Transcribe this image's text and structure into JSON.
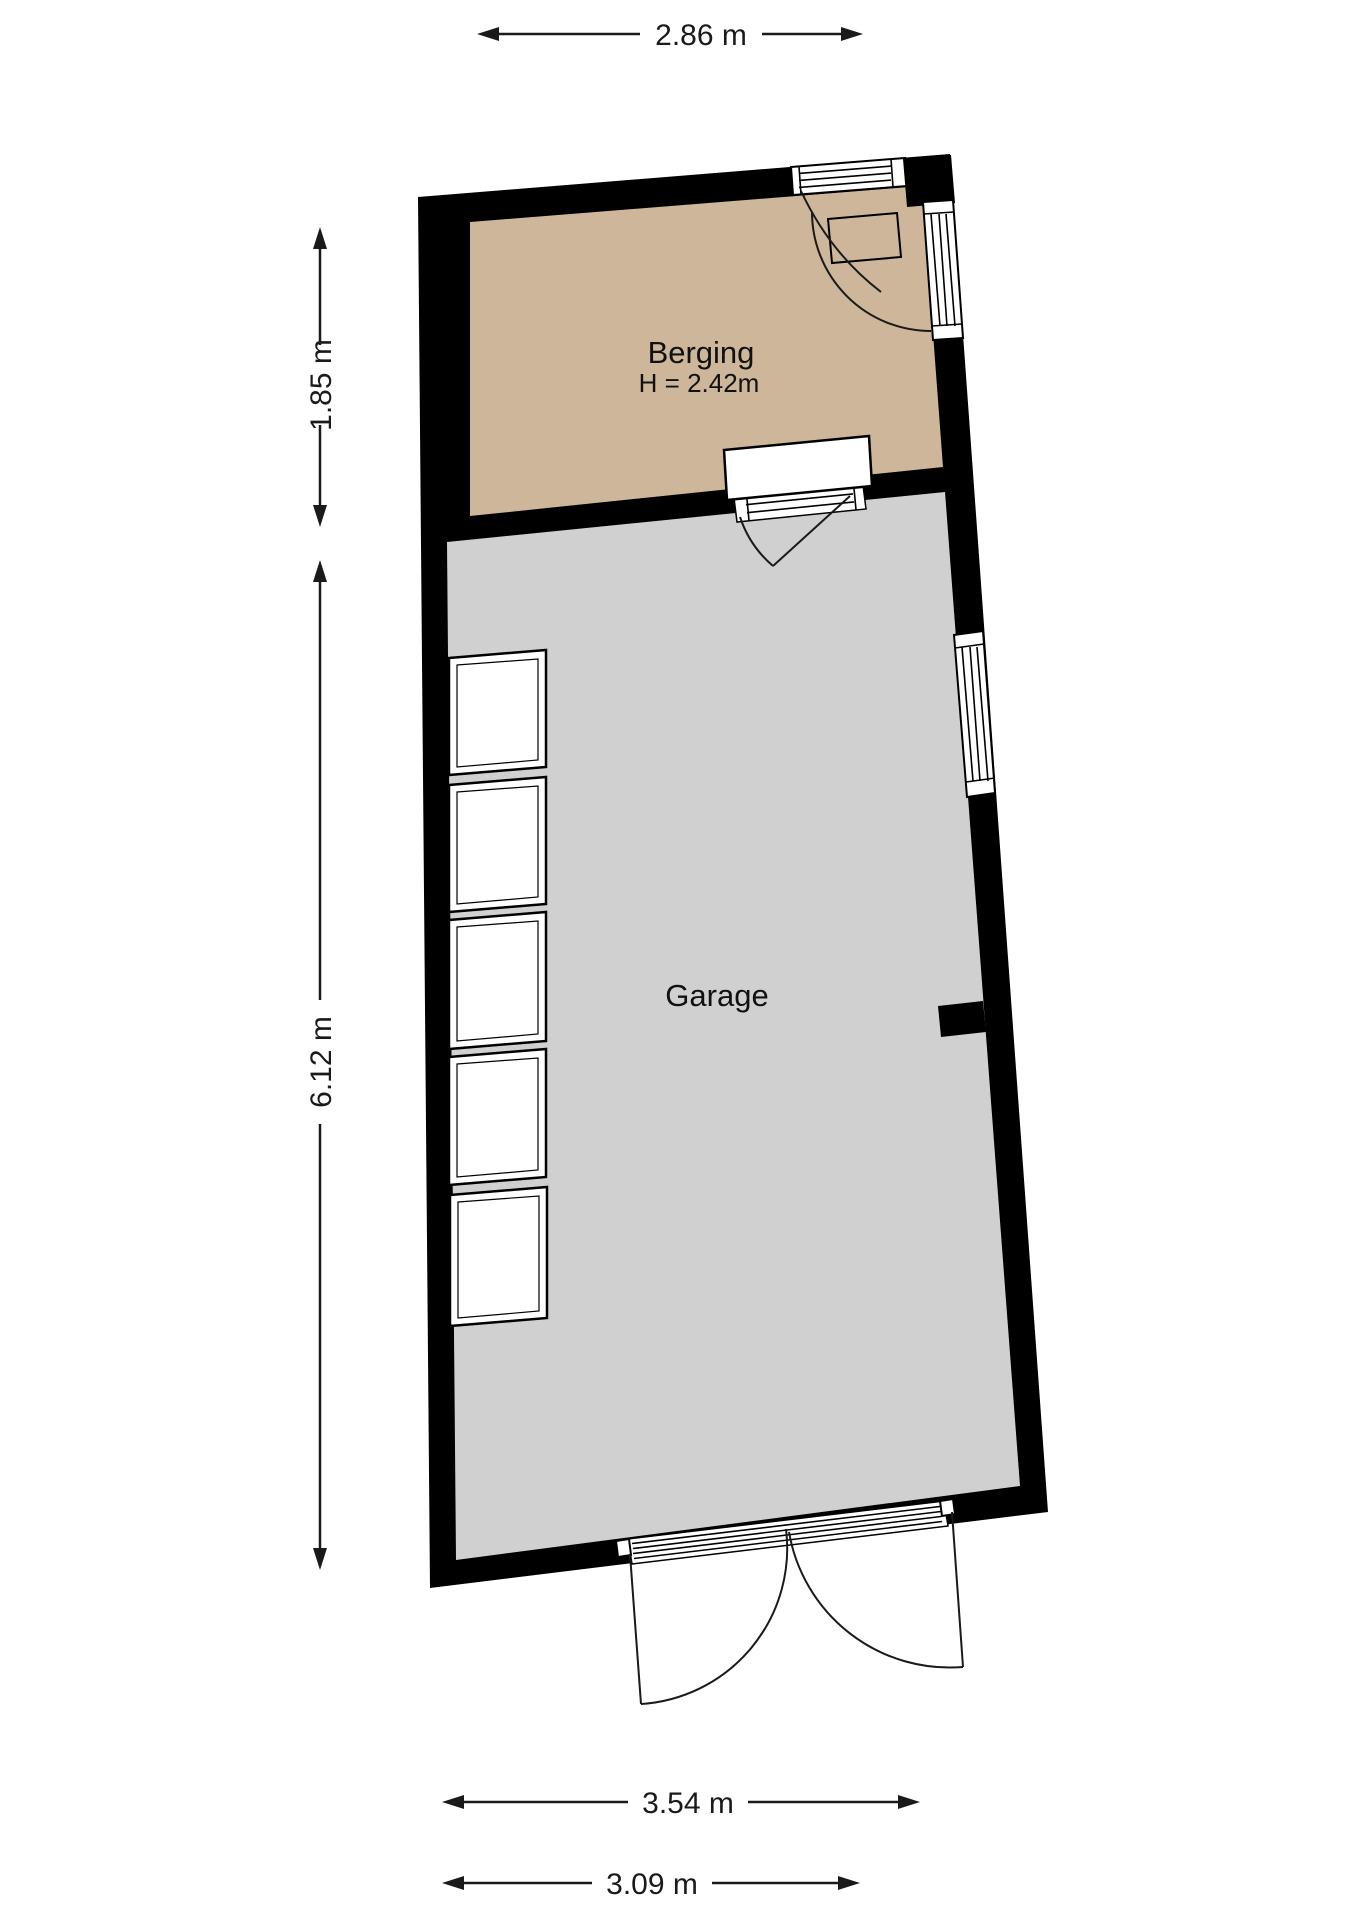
{
  "rooms": {
    "berging": {
      "label": "Berging",
      "height_label": "H = 2.42m",
      "fill": "#cdb699"
    },
    "garage": {
      "label": "Garage",
      "fill": "#d0d0d0"
    }
  },
  "dimensions": {
    "top": "2.86 m",
    "left_upper": "1.85 m",
    "left_lower": "6.12 m",
    "bottom_upper": "3.54 m",
    "bottom_lower": "3.09 m"
  },
  "colors": {
    "wall": "#000000",
    "background": "#ffffff",
    "line": "#1a1a1a"
  }
}
